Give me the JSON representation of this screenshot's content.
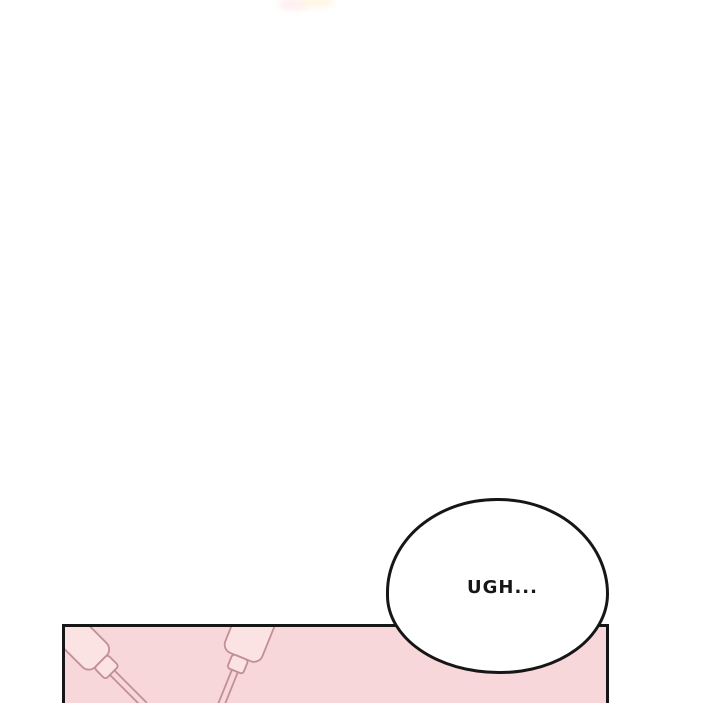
{
  "page": {
    "background_color": "#ffffff"
  },
  "speech_bubble": {
    "text": "UGH...",
    "fill_color": "#ffffff",
    "stroke_color": "#161616"
  },
  "bottom_panel": {
    "fill_color": "#f8d7da",
    "border_color": "#161616",
    "illustration": {
      "description": "two-charger-cables-line-art",
      "outline_color": "#c28f94",
      "fill_color": "#fbe3e4"
    }
  },
  "top_smudge": {
    "pink_color": "#ffeef0",
    "cream_color": "#fff6e4"
  }
}
